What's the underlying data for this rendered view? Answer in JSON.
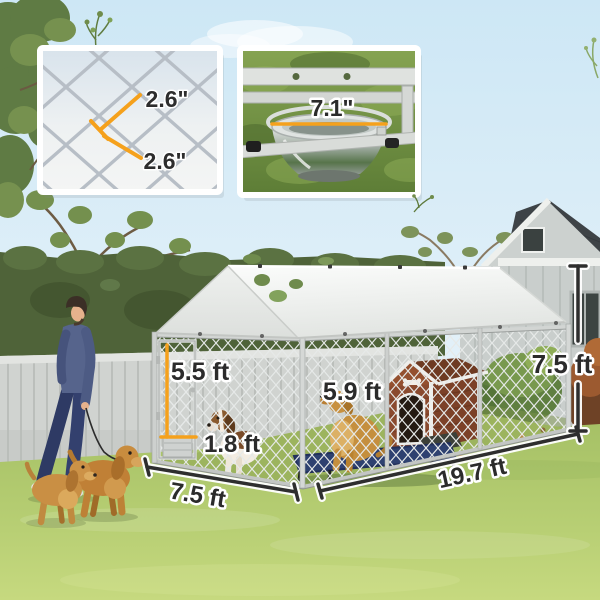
{
  "product_scene": {
    "description_labels": {
      "inset_mesh": {
        "top_label": "2.6\"",
        "bottom_label": "2.6\""
      },
      "inset_bowl": {
        "diameter_label": "7.1\""
      },
      "dimensions": {
        "door_height": "5.5 ft",
        "door_width": "1.8 ft",
        "interior_height": "5.9 ft",
        "frame_height": "7.5 ft",
        "run_length": "19.7 ft",
        "run_width": "7.5 ft"
      }
    },
    "colors": {
      "accent_orange": "#F5A11C",
      "dimension_line": "#2E2E2E",
      "label_text": "#2B2B2B",
      "canopy_white": "#F5F6F4",
      "grass_green": "#AFC86D",
      "sky_blue": "#CDE7F5"
    }
  }
}
